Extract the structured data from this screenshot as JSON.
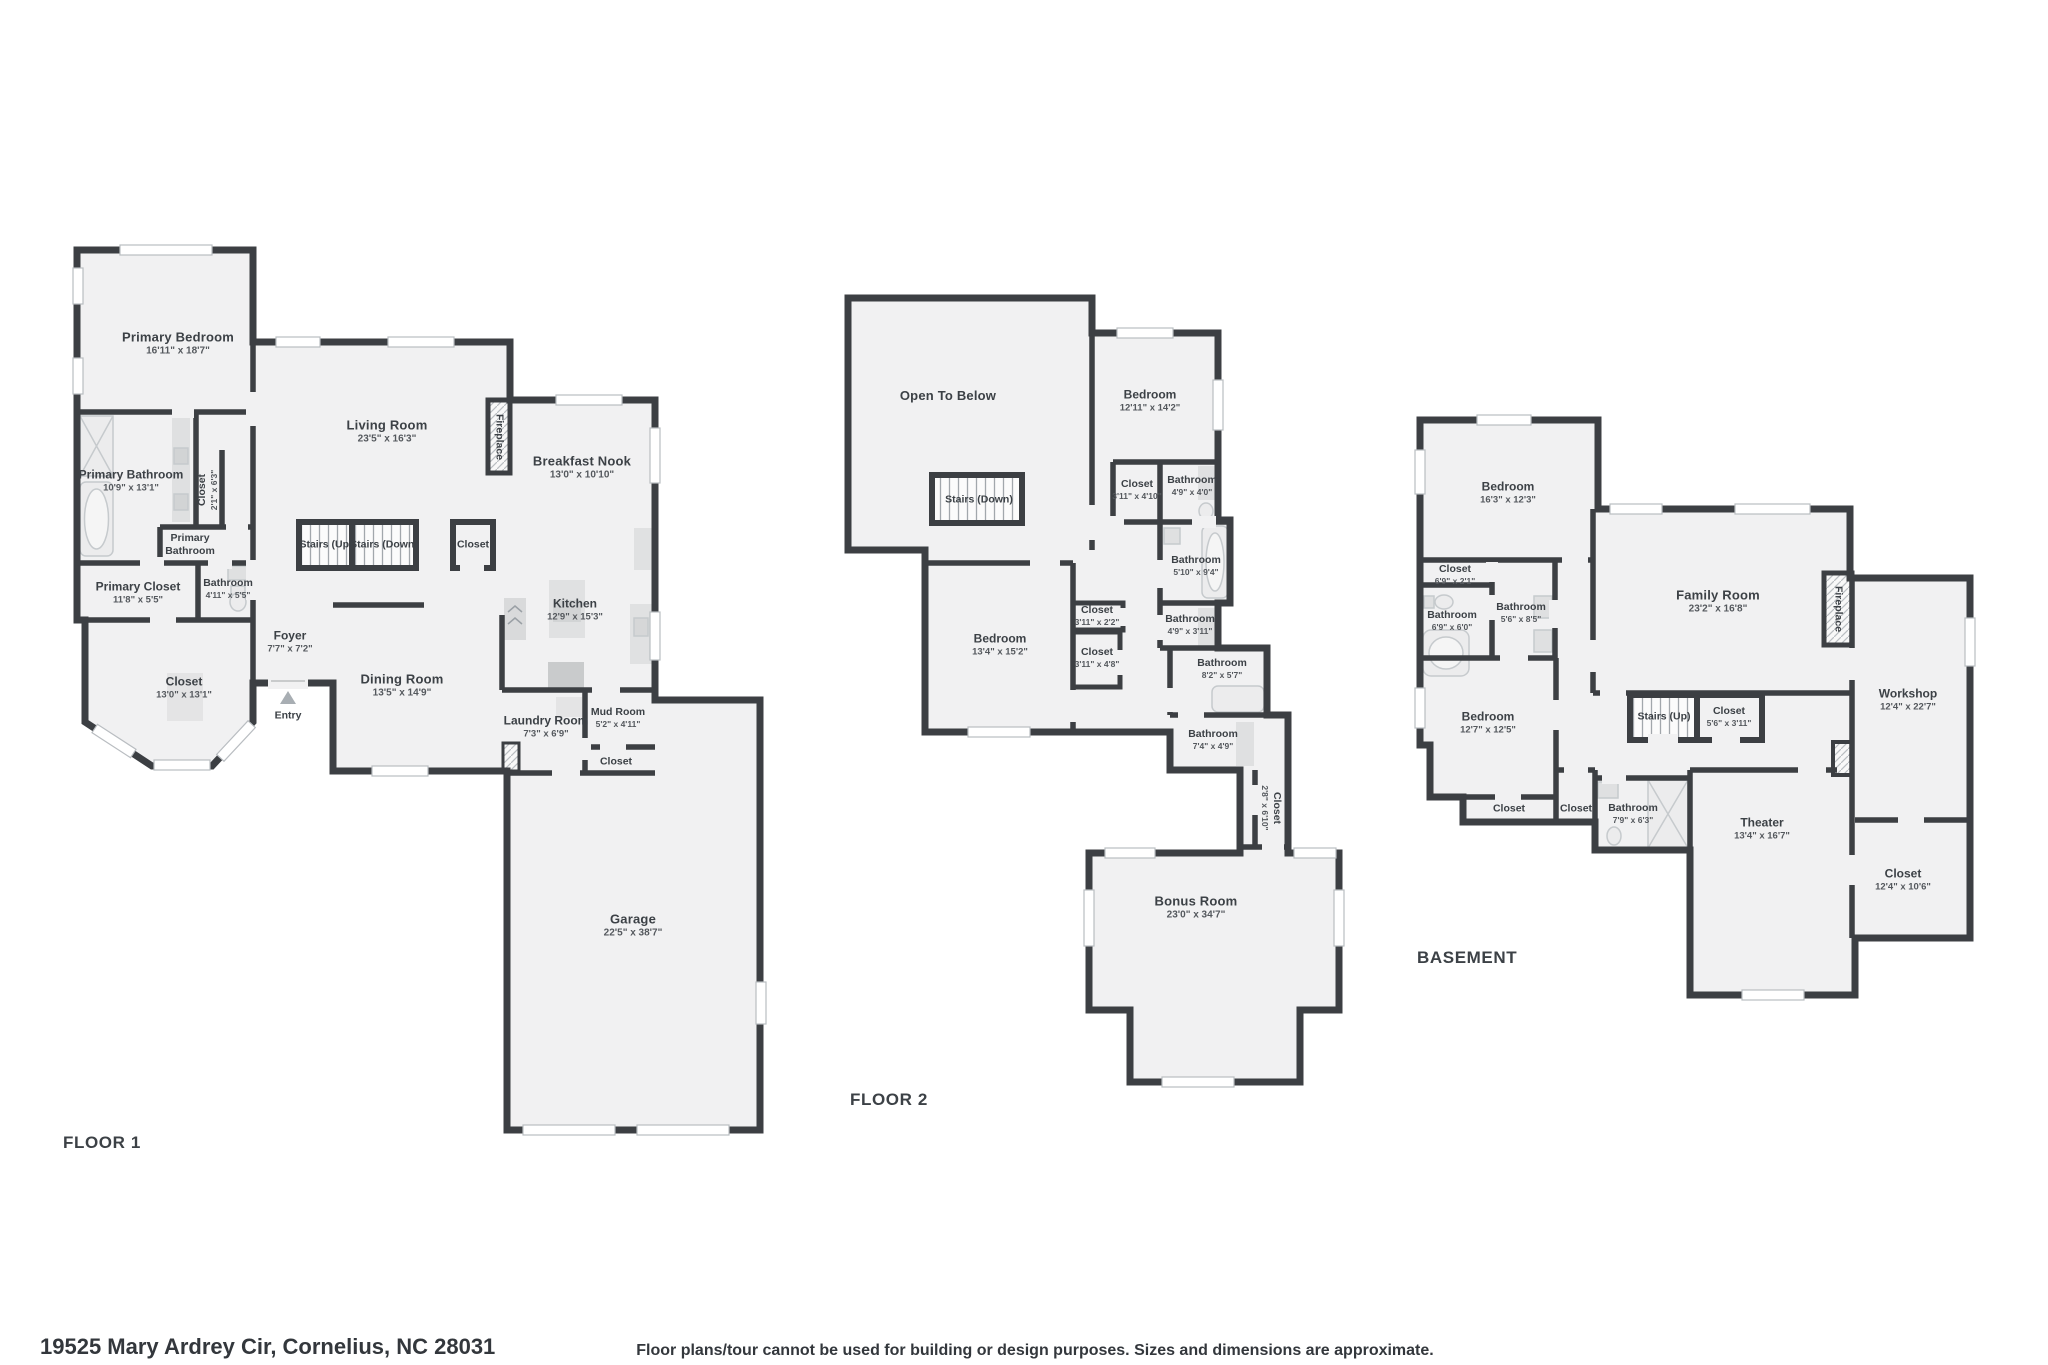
{
  "palette": {
    "wall": "#3c3f43",
    "floor": "#f1f1f2",
    "fixture": "#e3e3e4",
    "text": "#3c4146"
  },
  "footer": {
    "address": "19525 Mary Ardrey Cir, Cornelius, NC 28031",
    "disclaimer": "Floor plans/tour cannot be used for building or design purposes. Sizes and dimensions are approximate."
  },
  "floor1": {
    "title": "FLOOR 1",
    "rooms": {
      "primary_bedroom": {
        "name": "Primary Bedroom",
        "dims": "16'11\" x 18'7\""
      },
      "living_room": {
        "name": "Living Room",
        "dims": "23'5\" x 16'3\""
      },
      "breakfast_nook": {
        "name": "Breakfast Nook",
        "dims": "13'0\" x 10'10\""
      },
      "fireplace": {
        "name": "Fireplace"
      },
      "stairs_up": {
        "name": "Stairs (Up)"
      },
      "stairs_down": {
        "name": "Stairs (Down)"
      },
      "hall_closet": {
        "name": "Closet"
      },
      "closet_vertical": {
        "name": "Closet",
        "dims": "2'1\" x 6'3\""
      },
      "primary_bathroom": {
        "name": "Primary Bathroom",
        "dims": "10'9\" x 13'1\""
      },
      "primary_bathroom_small": {
        "name": "Primary Bathroom"
      },
      "primary_closet": {
        "name": "Primary Closet",
        "dims": "11'8\" x 5'5\""
      },
      "bathroom": {
        "name": "Bathroom",
        "dims": "4'11\" x 5'5\""
      },
      "bay_closet": {
        "name": "Closet",
        "dims": "13'0\" x 13'1\""
      },
      "foyer": {
        "name": "Foyer",
        "dims": "7'7\" x 7'2\""
      },
      "entry": {
        "name": "Entry"
      },
      "dining_room": {
        "name": "Dining Room",
        "dims": "13'5\" x 14'9\""
      },
      "kitchen": {
        "name": "Kitchen",
        "dims": "12'9\" x 15'3\""
      },
      "laundry_room": {
        "name": "Laundry Room",
        "dims": "7'3\" x 6'9\""
      },
      "mud_room": {
        "name": "Mud Room",
        "dims": "5'2\" x 4'11\""
      },
      "mud_closet": {
        "name": "Closet"
      },
      "garage": {
        "name": "Garage",
        "dims": "22'5\" x 38'7\""
      }
    }
  },
  "floor2": {
    "title": "FLOOR 2",
    "rooms": {
      "open_to_below": {
        "name": "Open To Below"
      },
      "bedroom_a": {
        "name": "Bedroom",
        "dims": "12'11\" x 14'2\""
      },
      "stairs_down": {
        "name": "Stairs (Down)"
      },
      "closet_a": {
        "name": "Closet",
        "dims": "3'11\" x 4'10\""
      },
      "bathroom_a": {
        "name": "Bathroom",
        "dims": "4'9\" x 4'0\""
      },
      "bathroom_b": {
        "name": "Bathroom",
        "dims": "5'10\" x 9'4\""
      },
      "bathroom_c": {
        "name": "Bathroom",
        "dims": "4'9\" x 3'11\""
      },
      "closet_b": {
        "name": "Closet",
        "dims": "3'11\" x 2'2\""
      },
      "closet_c": {
        "name": "Closet",
        "dims": "3'11\" x 4'8\""
      },
      "bedroom_b": {
        "name": "Bedroom",
        "dims": "13'4\" x 15'2\""
      },
      "bathroom_d": {
        "name": "Bathroom",
        "dims": "8'2\" x 5'7\""
      },
      "bathroom_e": {
        "name": "Bathroom",
        "dims": "7'4\" x 4'9\""
      },
      "closet_vertical": {
        "name": "Closet",
        "dims": "2'8\" x 6'10\""
      },
      "bonus_room": {
        "name": "Bonus Room",
        "dims": "23'0\" x 34'7\""
      }
    }
  },
  "basement": {
    "title": "BASEMENT",
    "rooms": {
      "bedroom_a": {
        "name": "Bedroom",
        "dims": "16'3\" x 12'3\""
      },
      "closet_a": {
        "name": "Closet",
        "dims": "6'9\" x 2'1\""
      },
      "bathroom_a": {
        "name": "Bathroom",
        "dims": "6'9\" x 6'0\""
      },
      "bathroom_b": {
        "name": "Bathroom",
        "dims": "5'6\" x 8'5\""
      },
      "family_room": {
        "name": "Family Room",
        "dims": "23'2\" x 16'8\""
      },
      "fireplace": {
        "name": "Fireplace"
      },
      "bedroom_b": {
        "name": "Bedroom",
        "dims": "12'7\" x 12'5\""
      },
      "stairs_up": {
        "name": "Stairs (Up)"
      },
      "closet_b": {
        "name": "Closet",
        "dims": "5'6\" x 3'11\""
      },
      "closet_c": {
        "name": "Closet"
      },
      "closet_d": {
        "name": "Closet"
      },
      "bathroom_c": {
        "name": "Bathroom",
        "dims": "7'9\" x 6'3\""
      },
      "theater": {
        "name": "Theater",
        "dims": "13'4\" x 16'7\""
      },
      "workshop": {
        "name": "Workshop",
        "dims": "12'4\" x 22'7\""
      },
      "closet_e": {
        "name": "Closet",
        "dims": "12'4\" x 10'6\""
      }
    }
  }
}
